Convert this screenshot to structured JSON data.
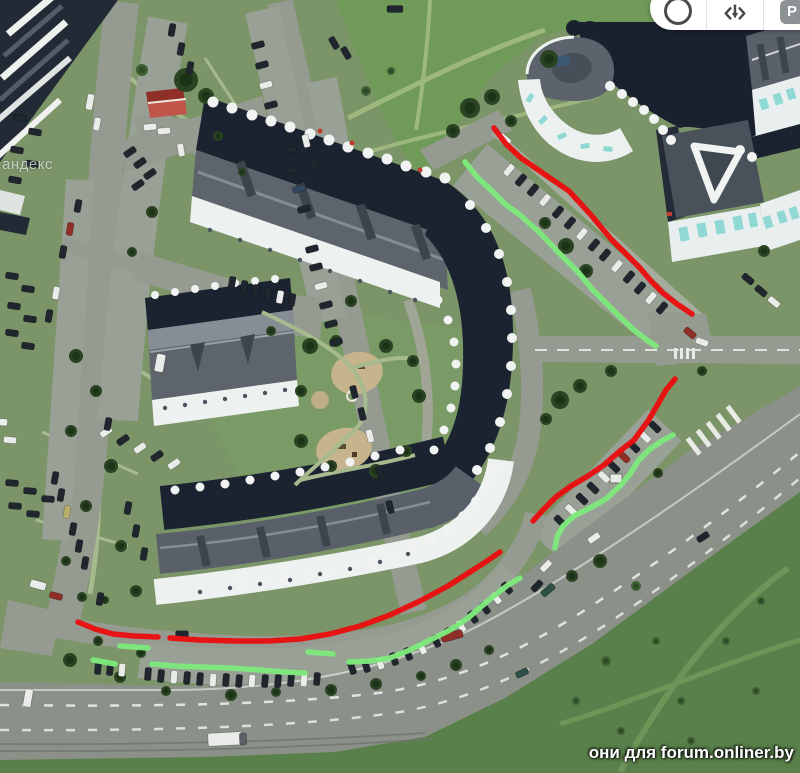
{
  "map": {
    "kind": "satellite-imagery",
    "scene": "residential block with horseshoe apartment building, parking lots and avenue"
  },
  "toolbar": {
    "buttons": [
      {
        "id": "compass",
        "icon": "circle-icon",
        "label": ""
      },
      {
        "id": "tilt-3d",
        "icon": "rotate-3d-icon",
        "label": ""
      },
      {
        "id": "parking",
        "icon": "parking-icon",
        "label": "P"
      }
    ]
  },
  "watermarks": {
    "map_provider_fragment": "андекс",
    "forum_caption": "они для forum.onliner.by"
  },
  "annotations": {
    "stroke_width": 5.5,
    "colors": {
      "red": "#e81010",
      "green": "#7de87c"
    },
    "lines": [
      {
        "color": "red",
        "points": [
          [
            494,
            128
          ],
          [
            506,
            144
          ],
          [
            521,
            158
          ],
          [
            547,
            176
          ],
          [
            569,
            191
          ],
          [
            591,
            215
          ],
          [
            611,
            239
          ],
          [
            623,
            251
          ],
          [
            639,
            267
          ],
          [
            651,
            281
          ],
          [
            663,
            293
          ],
          [
            677,
            304
          ],
          [
            692,
            314
          ]
        ]
      },
      {
        "color": "red",
        "points": [
          [
            675,
            379
          ],
          [
            666,
            390
          ],
          [
            658,
            404
          ],
          [
            648,
            421
          ],
          [
            634,
            440
          ],
          [
            620,
            451
          ],
          [
            604,
            465
          ],
          [
            588,
            476
          ],
          [
            571,
            486
          ],
          [
            556,
            497
          ],
          [
            543,
            510
          ],
          [
            533,
            521
          ]
        ]
      },
      {
        "color": "red",
        "points": [
          [
            78,
            622
          ],
          [
            95,
            629
          ],
          [
            113,
            634
          ],
          [
            134,
            636
          ],
          [
            158,
            637
          ]
        ]
      },
      {
        "color": "red",
        "points": [
          [
            170,
            638
          ],
          [
            200,
            640
          ],
          [
            235,
            641
          ],
          [
            268,
            641
          ],
          [
            300,
            639
          ],
          [
            330,
            634
          ],
          [
            360,
            626
          ],
          [
            390,
            615
          ],
          [
            420,
            601
          ],
          [
            448,
            586
          ],
          [
            470,
            572
          ],
          [
            487,
            561
          ],
          [
            500,
            552
          ]
        ]
      },
      {
        "color": "green",
        "points": [
          [
            465,
            162
          ],
          [
            478,
            178
          ],
          [
            492,
            191
          ],
          [
            505,
            204
          ],
          [
            520,
            215
          ],
          [
            540,
            233
          ],
          [
            558,
            252
          ],
          [
            578,
            272
          ],
          [
            592,
            289
          ],
          [
            606,
            303
          ],
          [
            620,
            317
          ],
          [
            634,
            330
          ],
          [
            648,
            341
          ],
          [
            656,
            346
          ]
        ]
      },
      {
        "color": "green",
        "points": [
          [
            673,
            435
          ],
          [
            662,
            441
          ],
          [
            650,
            449
          ],
          [
            638,
            461
          ],
          [
            630,
            474
          ],
          [
            620,
            486
          ],
          [
            606,
            499
          ],
          [
            590,
            508
          ],
          [
            574,
            516
          ],
          [
            563,
            526
          ],
          [
            557,
            537
          ],
          [
            555,
            548
          ]
        ]
      },
      {
        "color": "green",
        "points": [
          [
            93,
            660
          ],
          [
            104,
            662
          ],
          [
            115,
            664
          ]
        ]
      },
      {
        "color": "green",
        "points": [
          [
            120,
            646
          ],
          [
            134,
            647
          ],
          [
            148,
            648
          ]
        ]
      },
      {
        "color": "green",
        "points": [
          [
            152,
            664
          ],
          [
            175,
            666
          ],
          [
            200,
            667
          ],
          [
            230,
            668
          ],
          [
            260,
            670
          ],
          [
            285,
            672
          ],
          [
            305,
            673
          ]
        ]
      },
      {
        "color": "green",
        "points": [
          [
            308,
            652
          ],
          [
            320,
            653
          ],
          [
            333,
            654
          ]
        ]
      },
      {
        "color": "green",
        "points": [
          [
            349,
            662
          ],
          [
            370,
            661
          ],
          [
            390,
            658
          ],
          [
            410,
            650
          ],
          [
            430,
            640
          ],
          [
            450,
            630
          ],
          [
            468,
            618
          ],
          [
            483,
            605
          ],
          [
            495,
            595
          ],
          [
            508,
            585
          ],
          [
            520,
            578
          ]
        ]
      }
    ]
  }
}
